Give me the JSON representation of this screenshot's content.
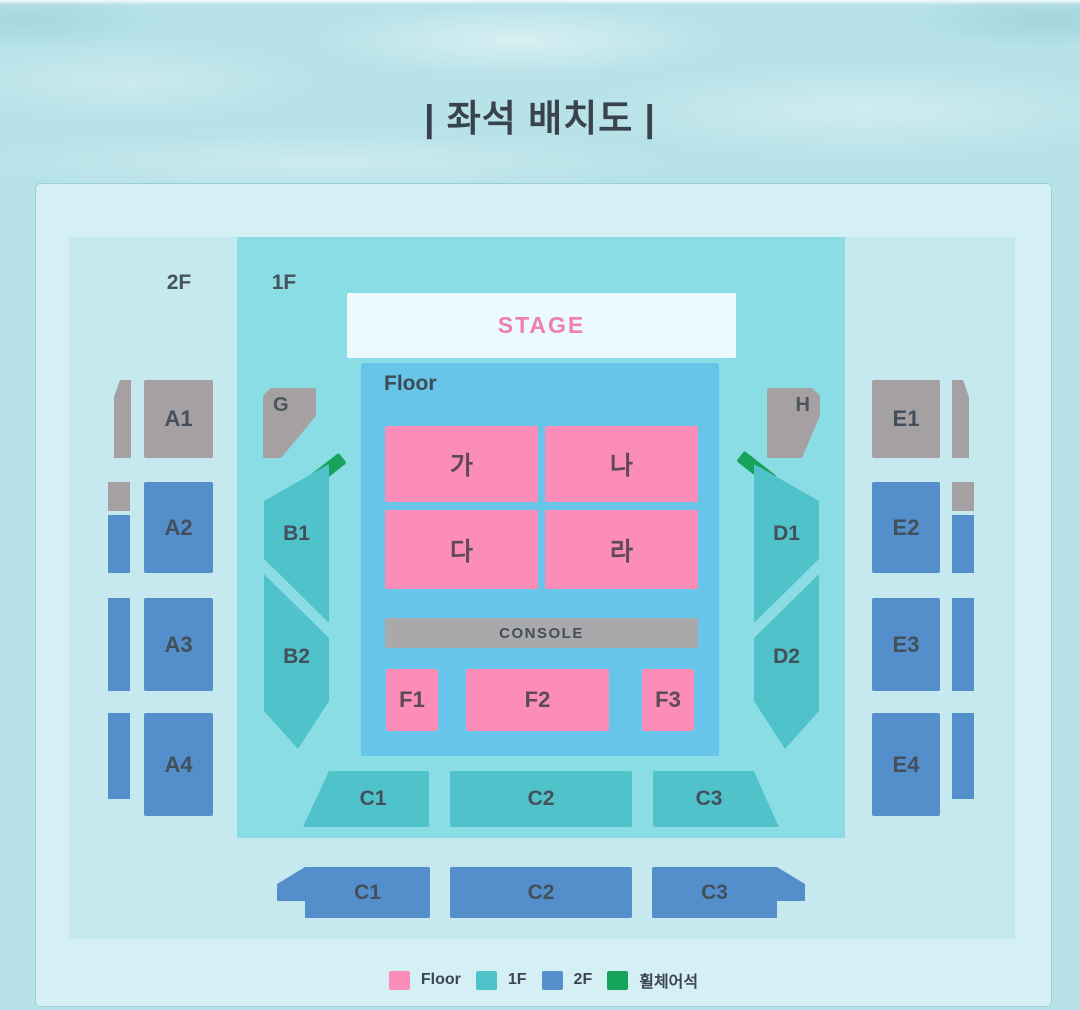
{
  "title": "| 좌석 배치도 |",
  "map": {
    "zone_labels": {
      "second_floor": "2F",
      "first_floor": "1F"
    },
    "stage_label": "STAGE",
    "floor_label": "Floor",
    "floor_sections": [
      "가",
      "나",
      "다",
      "라"
    ],
    "console_label": "CONSOLE",
    "f_sections": [
      "F1",
      "F2",
      "F3"
    ],
    "c_sections_1f": [
      "C1",
      "C2",
      "C3"
    ],
    "c_sections_2f": [
      "C1",
      "C2",
      "C3"
    ],
    "left_gate": "G",
    "right_gate": "H",
    "left_side_sections": [
      "B1",
      "B2"
    ],
    "right_side_sections": [
      "D1",
      "D2"
    ],
    "left_2f_sections": [
      "A1",
      "A2",
      "A3",
      "A4"
    ],
    "right_2f_sections": [
      "E1",
      "E2",
      "E3",
      "E4"
    ]
  },
  "legend": {
    "items": [
      {
        "label": "Floor",
        "color": "#fb8db8"
      },
      {
        "label": "1F",
        "color": "#4fc2ca"
      },
      {
        "label": "2F",
        "color": "#548ecb"
      },
      {
        "label": "휠체어석",
        "color": "#16a35c"
      }
    ]
  },
  "colors": {
    "floor_section": "#fb8db8",
    "first_floor_section": "#4fc2ca",
    "second_floor_section": "#548ecb",
    "wheelchair": "#16a35c",
    "gray_section": "#a5a1a2",
    "stage_text": "#ee7fb2",
    "floor_zone_bg": "#66c5e9",
    "first_floor_zone_bg": "#8adde5",
    "second_floor_zone_bg": "#c5e9ee"
  }
}
